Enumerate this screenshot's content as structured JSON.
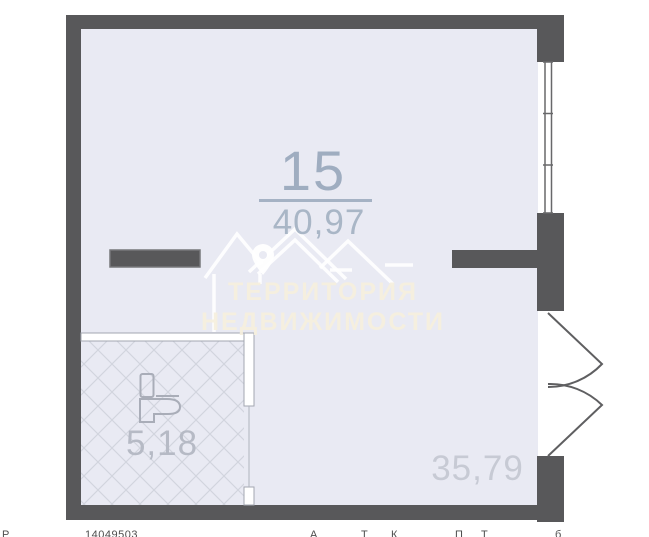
{
  "plan": {
    "unit_number": "15",
    "unit_area": "40,97",
    "bathroom_area": "5,18",
    "room_area": "35,79"
  },
  "watermark": {
    "line1": "ТЕРРИТОРИЯ",
    "line2": "НЕДВИЖИМОСТИ"
  },
  "footer": {
    "fragment_left": "Р",
    "listing_id": "14049503",
    "fragments_right": [
      "А",
      "Т",
      "К",
      "П",
      "Т",
      "б"
    ]
  },
  "colors": {
    "wall": "#58585a",
    "floor": "#e9eaf3",
    "hatch_line": "#d2d5de",
    "partition_outline": "#a3a7b1",
    "unit_label": "#9fadc0",
    "unit_area_label": "#a9b6c6",
    "bathroom_label": "#b6bac5",
    "room_label": "#c7cad4",
    "watermark_text": "#f5efdd",
    "watermark_lines": "#ffffff"
  }
}
